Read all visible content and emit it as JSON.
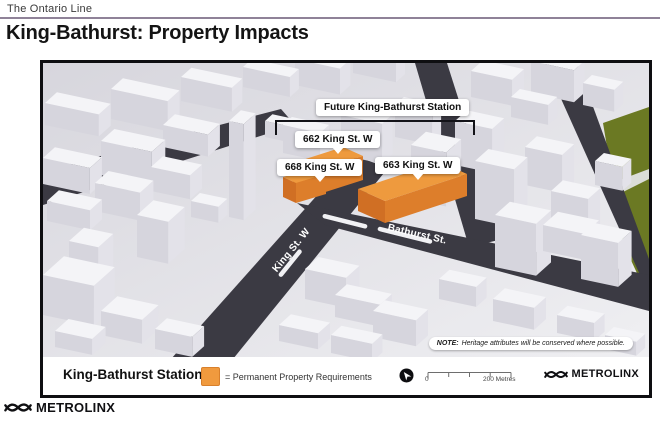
{
  "header": {
    "kicker": "The Ontario Line",
    "title": "King-Bathurst: Property Impacts"
  },
  "map": {
    "station_callout": "Future King-Bathurst Station",
    "buildings": [
      {
        "label": "662 King St. W"
      },
      {
        "label": "668 King St. W"
      },
      {
        "label": "663 King St. W"
      }
    ],
    "streets": {
      "king": "King St. W",
      "bathurst": "Bathurst St."
    },
    "note": {
      "prefix": "NOTE:",
      "text": "Heritage attributes will be conserved where possible."
    }
  },
  "legend": {
    "station_name": "King-Bathurst Station",
    "swatch_label": "= Permanent Property Requirements",
    "scale": {
      "start_label": "0",
      "end_label": "200 Metres"
    },
    "brand": "METROLINX"
  },
  "footer": {
    "brand": "METROLINX"
  },
  "colors": {
    "highlight_orange": "#EE9A3E",
    "highlight_orange_dark": "#DD7E2B",
    "street": "#3B3A43",
    "park": "#6B7923",
    "rule": "#8F8298"
  }
}
